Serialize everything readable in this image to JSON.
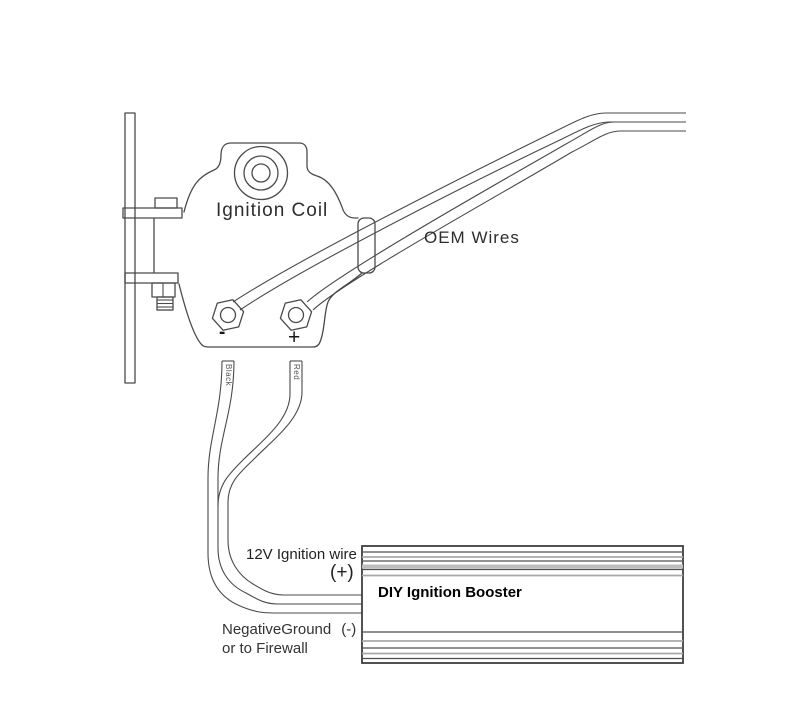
{
  "title": "Ignition coil to DIY ignition booster wiring diagram",
  "coil": {
    "label": "Ignition Coil",
    "terminal_negative": "-",
    "terminal_positive": "+"
  },
  "wires": {
    "oem_label": "OEM Wires",
    "black_label": "Black",
    "red_label": "Red",
    "ignition_label": "12V Ignition wire",
    "ignition_polarity": "(+)",
    "ground_label": "NegativeGround",
    "ground_polarity": "(-)",
    "ground_label_line2": "or to Firewall"
  },
  "booster": {
    "label": "DIY Ignition Booster"
  },
  "colors": {
    "background": "#ffffff",
    "line": "#4a4a4a",
    "text": "#1f1f1f",
    "fin_gray": "#bdbdbd"
  }
}
